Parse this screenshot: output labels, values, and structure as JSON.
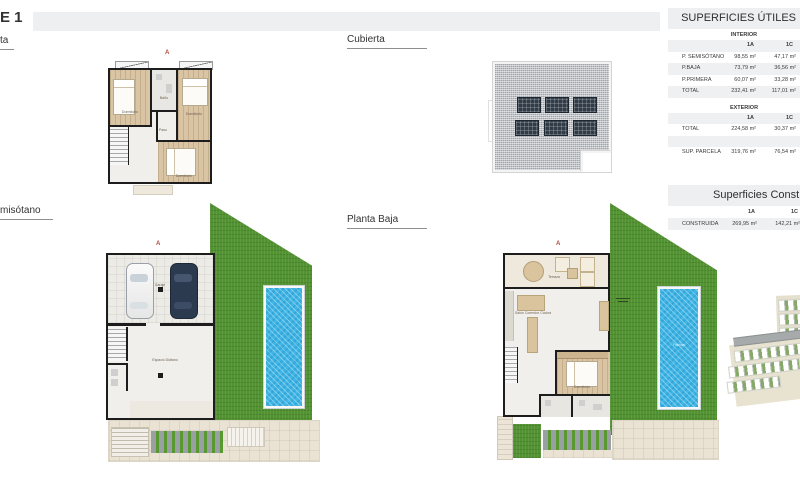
{
  "header": {
    "title": "E 1"
  },
  "plan_labels": {
    "primera": "ta",
    "cubierta": "Cubierta",
    "semisotano": "misótano",
    "baja": "Planta Baja"
  },
  "marker": "A",
  "rooms": {
    "dormitorio": "Dormitorio",
    "bano": "Baño",
    "paso": "Paso",
    "garaje": "Garaje",
    "espacio_diafano": "Espacio Diáfano",
    "salon": "Salón Comedor Cocina",
    "terraza": "Terraza",
    "piscina": "Piscina"
  },
  "tables": {
    "utiles": {
      "title": "SUPERFICIES ÚTILES",
      "interior": {
        "name": "INTERIOR",
        "col_a": "1A",
        "col_c": "1C",
        "rows": [
          {
            "label": "P. SEMISÓTANO",
            "a": "98,55 m²",
            "c": "47,17 m²"
          },
          {
            "label": "P.BAJA",
            "a": "73,79 m²",
            "c": "36,56 m²"
          },
          {
            "label": "P.PRIMERA",
            "a": "60,07 m²",
            "c": "33,28 m²"
          },
          {
            "label": "TOTAL",
            "a": "232,41 m²",
            "c": "117,01 m²"
          }
        ]
      },
      "exterior": {
        "name": "EXTERIOR",
        "col_a": "1A",
        "col_c": "1C",
        "rows": [
          {
            "label": "TOTAL",
            "a": "224,58 m²",
            "c": "30,37 m²"
          },
          {
            "label": "SUP. PARCELA",
            "a": "319,76 m²",
            "c": "76,54 m²"
          }
        ]
      }
    },
    "construidas": {
      "title": "Superficies Construidas",
      "col_a": "1A",
      "col_c": "1C",
      "rows": [
        {
          "label": "CONSTRUIDA",
          "a": "269,95 m²",
          "c": "142,21 m²"
        }
      ]
    }
  },
  "colors": {
    "accent_red": "#b0493c",
    "grass_green": "#529331",
    "pool_blue": "#3eb6e6",
    "roof_gray": "#bcc0c4",
    "solar_panel": "#323c48",
    "wall_black": "#1d1d1d",
    "band_gray": "#edeff0",
    "row_gray": "#eef0f2"
  }
}
